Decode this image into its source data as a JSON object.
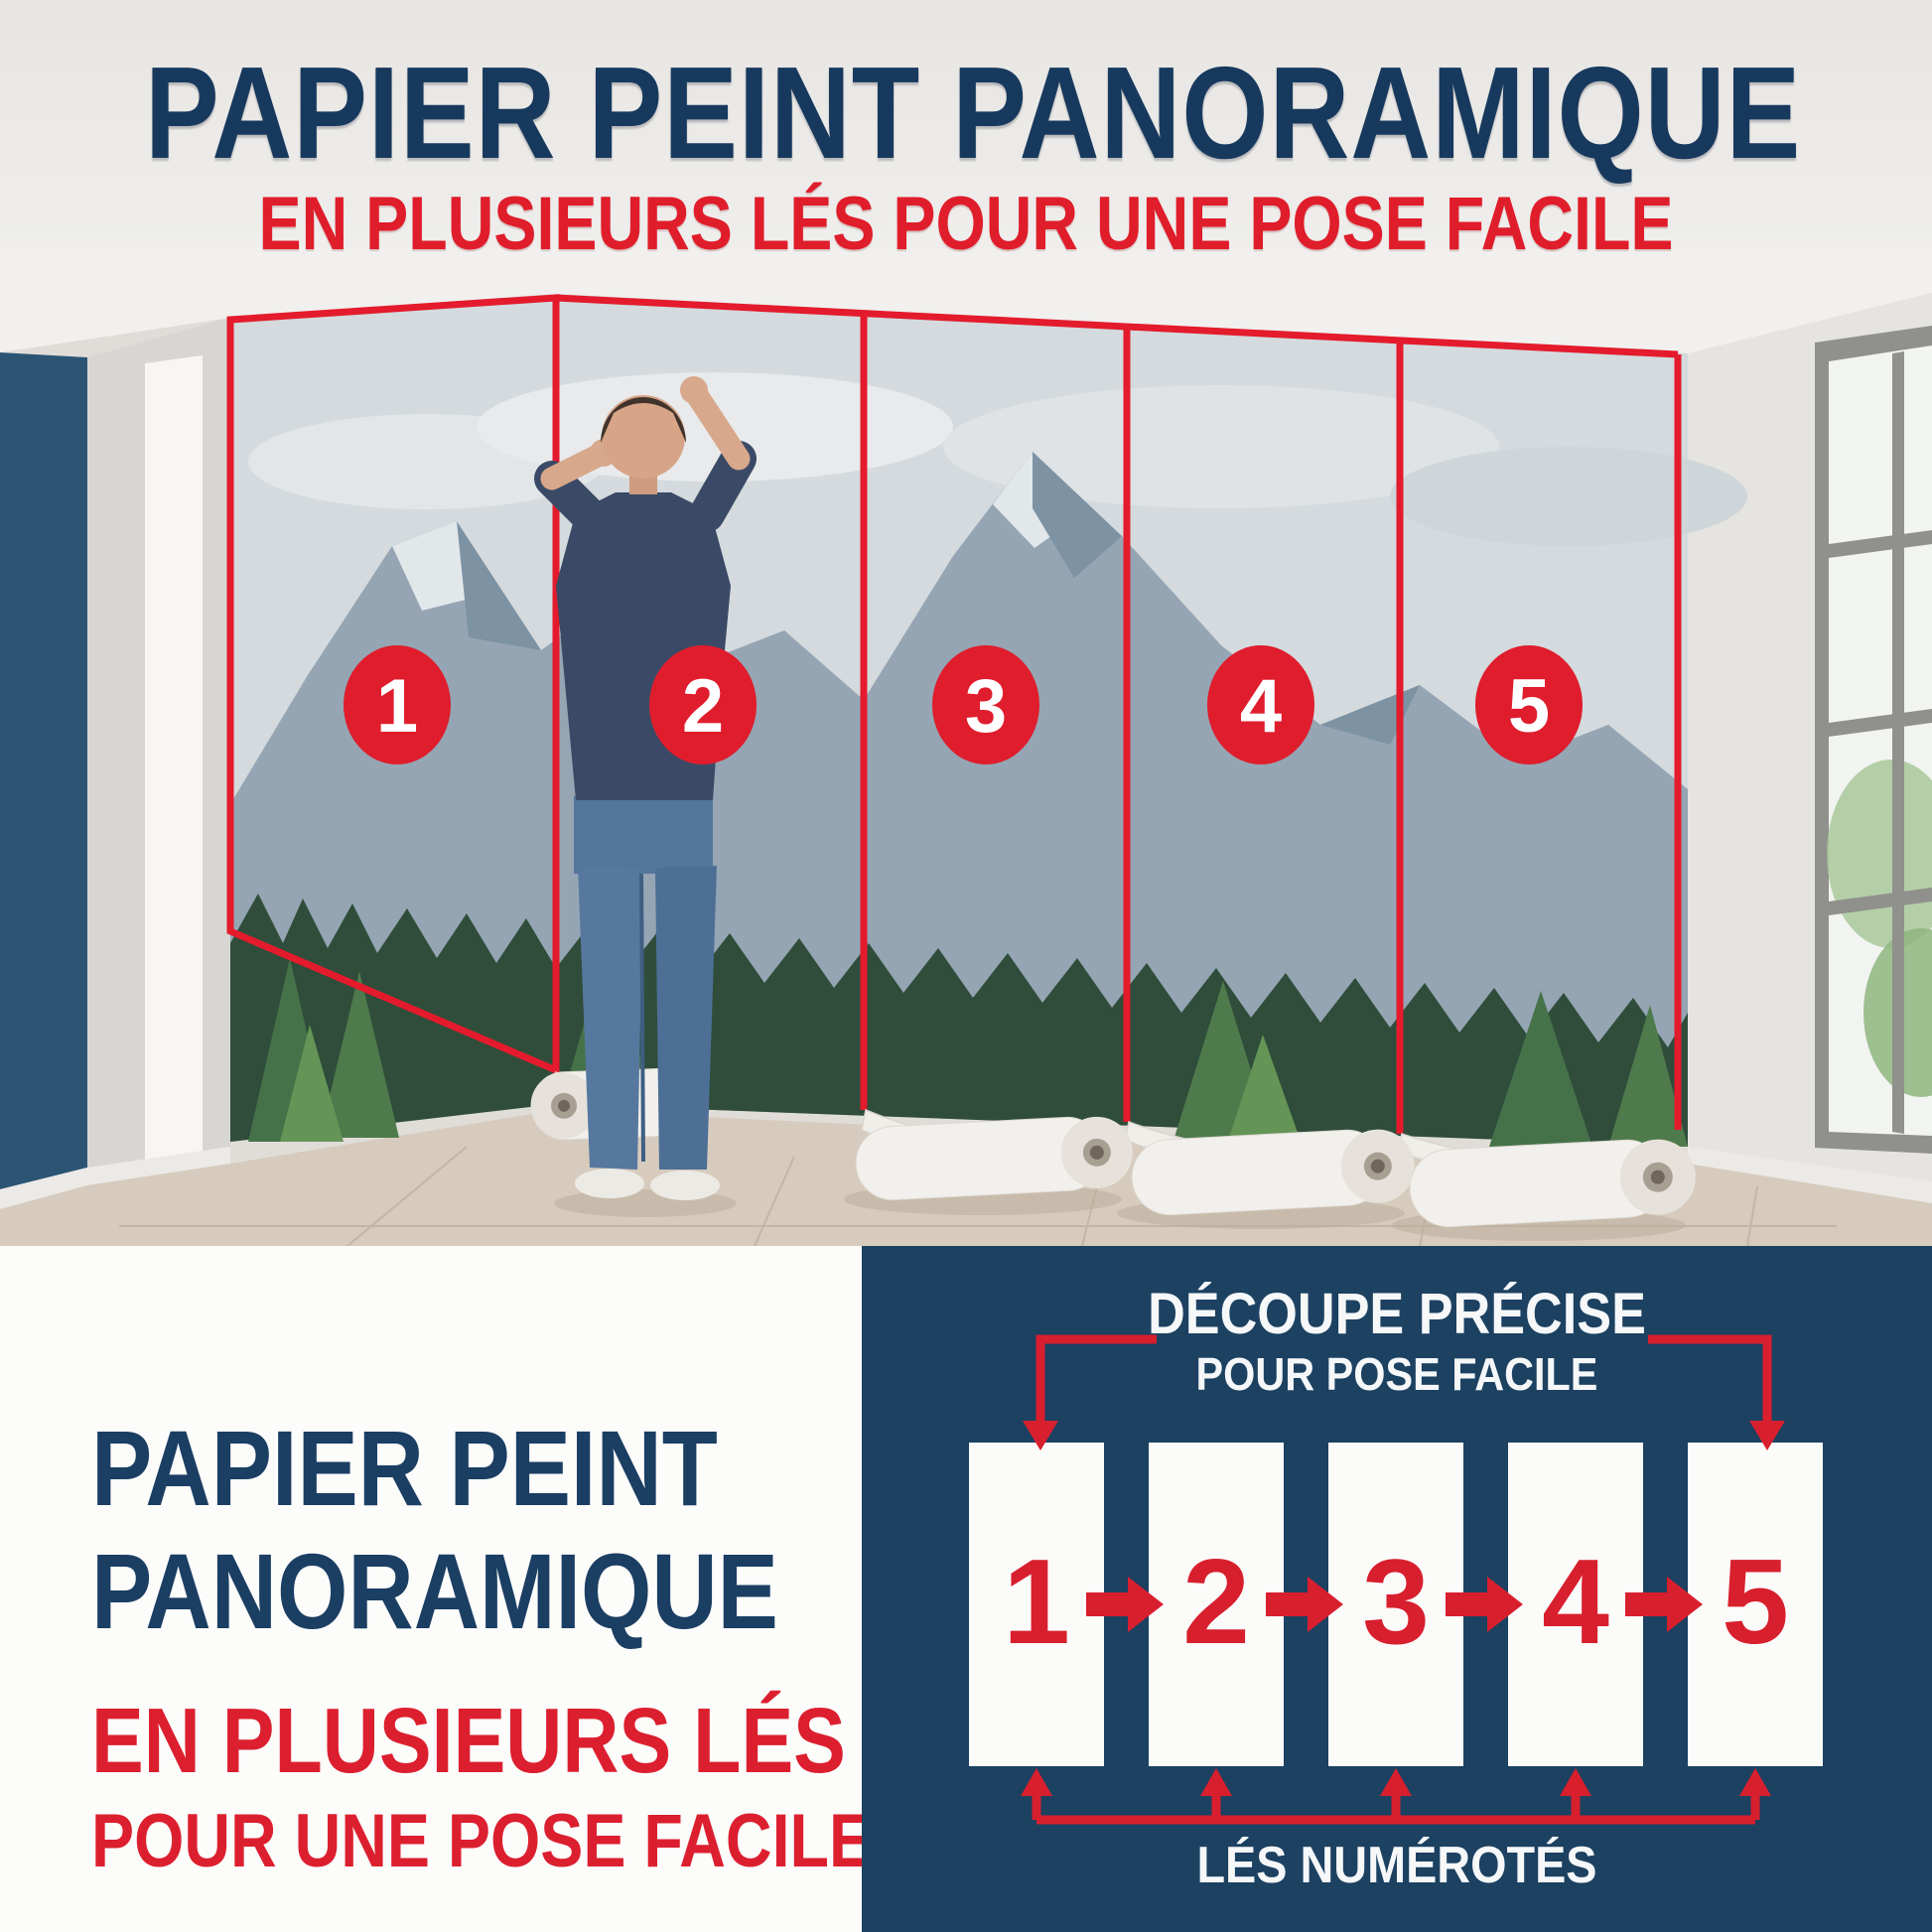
{
  "header": {
    "title": "PAPIER PEINT PANORAMIQUE",
    "subtitle": "EN PLUSIEURS LÉS POUR UNE POSE FACILE"
  },
  "photo": {
    "description": "man installing panoramic mountain-forest wallpaper in five numbered strips",
    "strips": [
      {
        "number": "1"
      },
      {
        "number": "2"
      },
      {
        "number": "3"
      },
      {
        "number": "4"
      },
      {
        "number": "5"
      }
    ]
  },
  "bottom_left": {
    "title_line1": "PAPIER PEINT",
    "title_line2": "PANORAMIQUE",
    "subtitle_line1": "EN PLUSIEURS LÉS",
    "subtitle_line2": "POUR UNE POSE FACILE"
  },
  "diagram": {
    "title_line1": "DÉCOUPE PRÉCISE",
    "title_line2": "POUR POSE FACILE",
    "strips": [
      {
        "number": "1"
      },
      {
        "number": "2"
      },
      {
        "number": "3"
      },
      {
        "number": "4"
      },
      {
        "number": "5"
      }
    ],
    "caption": "LÉS NUMÉROTÉS"
  },
  "colors": {
    "navy_text": "#17395d",
    "red": "#dc1f2f",
    "panel_navy": "#1c4161",
    "accent_wall": "#2b5573"
  }
}
